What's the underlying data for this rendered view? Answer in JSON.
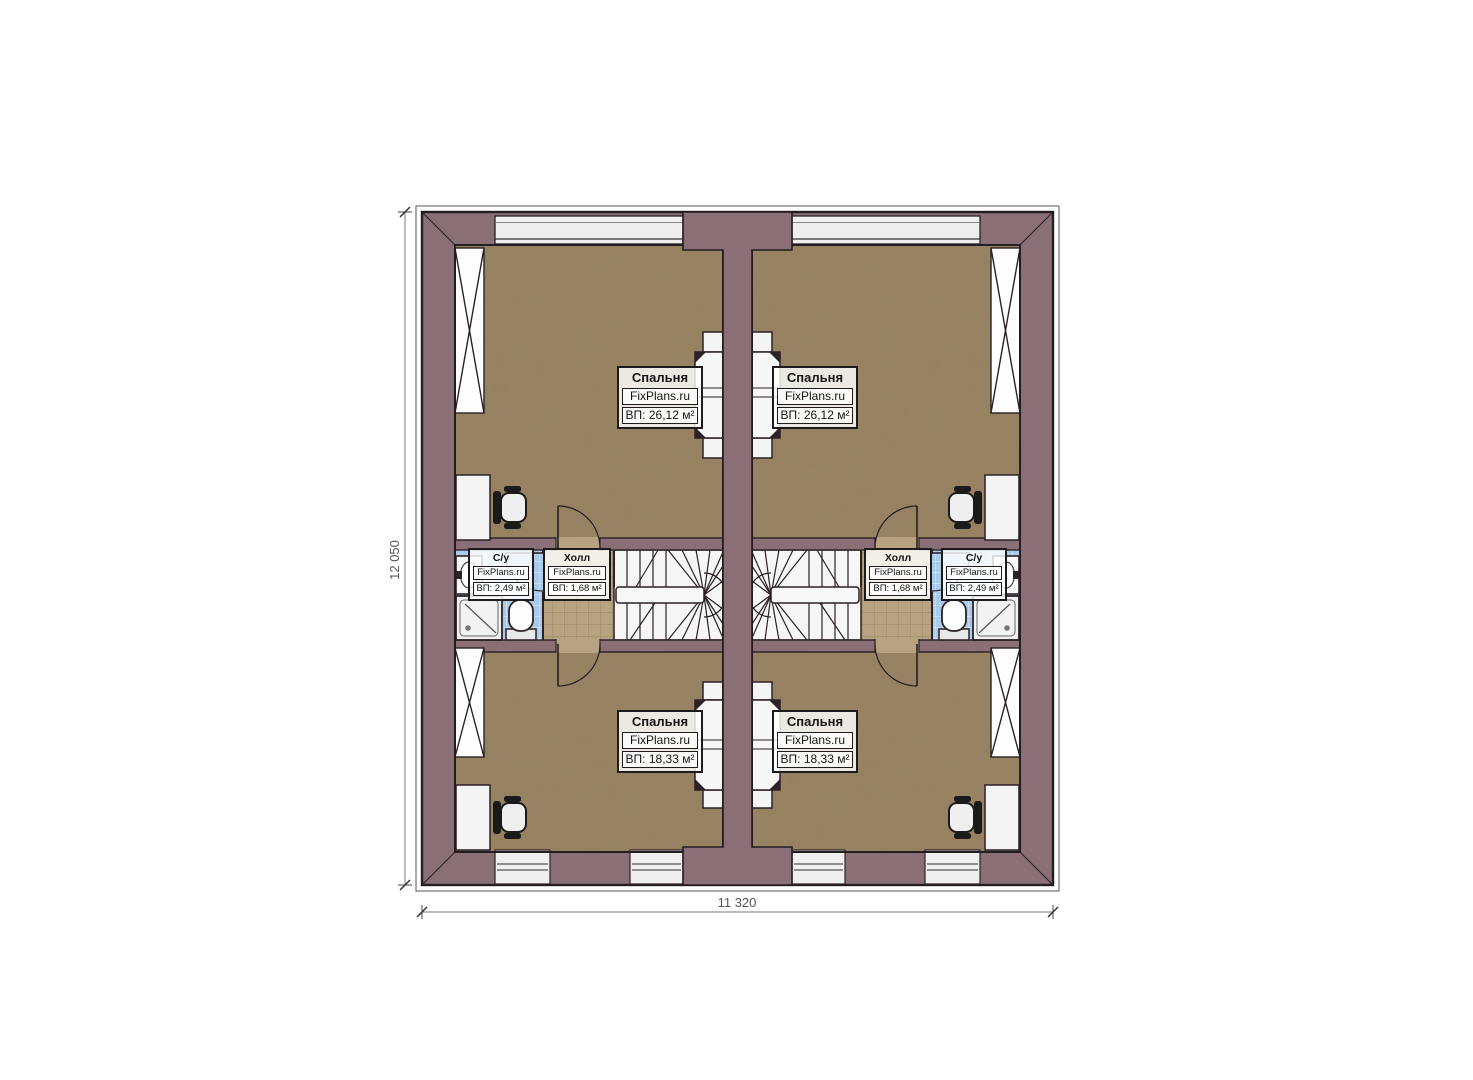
{
  "drawing": {
    "type": "floor-plan",
    "brand_watermark": "FixPlans.ru"
  },
  "dimensions": {
    "height_label": "12 050",
    "width_label": "11 320"
  },
  "rooms": {
    "left_bedroom_top": {
      "name": "Спальня",
      "brand": "FixPlans.ru",
      "area": "ВП: 26,12 м²"
    },
    "right_bedroom_top": {
      "name": "Спальня",
      "brand": "FixPlans.ru",
      "area": "ВП: 26,12 м²"
    },
    "left_bedroom_bottom": {
      "name": "Спальня",
      "brand": "FixPlans.ru",
      "area": "ВП: 18,33 м²"
    },
    "right_bedroom_bottom": {
      "name": "Спальня",
      "brand": "FixPlans.ru",
      "area": "ВП: 18,33 м²"
    },
    "left_hall": {
      "name": "Холл",
      "brand": "FixPlans.ru",
      "area": "ВП: 1,68 м²"
    },
    "right_hall": {
      "name": "Холл",
      "brand": "FixPlans.ru",
      "area": "ВП: 1,68 м²"
    },
    "left_bath": {
      "name": "С/у",
      "brand": "FixPlans.ru",
      "area": "ВП: 2,49 м²"
    },
    "right_bath": {
      "name": "С/у",
      "brand": "FixPlans.ru",
      "area": "ВП: 2,49 м²"
    }
  },
  "colors": {
    "wall": "#8a6f76",
    "outline": "#271e22",
    "bedroom_floor": "#96805f",
    "hall_tile": "#b7a282",
    "bath_tile": "#a9cbe9",
    "fixture_white": "#f4f4f4",
    "dimension_line": "#777777"
  }
}
